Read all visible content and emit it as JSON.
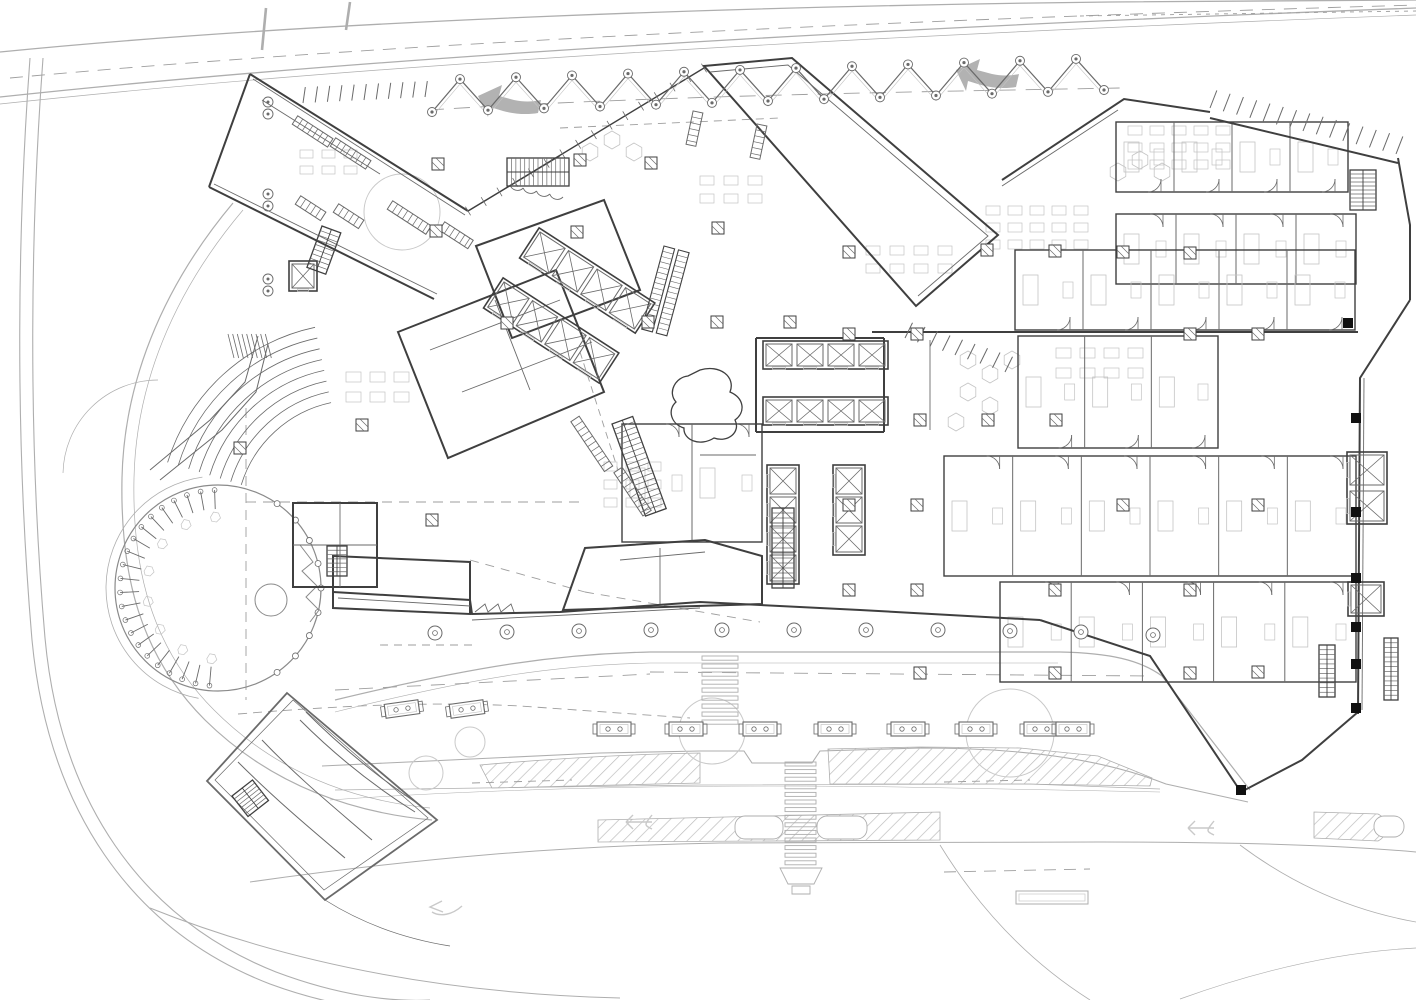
{
  "meta": {
    "drawing_type": "architectural-ground-floor-site-plan",
    "has_text_labels": false
  },
  "colors": {
    "bg": "#ffffff",
    "wall": "#3f3f3f",
    "partition": "#6a6a6a",
    "site": "#aeaeae",
    "siteLight": "#c9c9c9",
    "detail": "#c4c4c4",
    "dash": "#9e9e9e",
    "arrowFill": "#b2b2b2",
    "hatch": "#bdbdbd",
    "black": "#111111",
    "courtyard": "#8a8a8a"
  },
  "site": {
    "roads": [
      {
        "d": "M0,52 C320,20 760,6 1110,2 L1416,0",
        "w": 1.3
      },
      {
        "d": "M0,97 C380,56 880,28 1416,8",
        "w": 1.3
      },
      {
        "d": "M0,104 C380,63 880,35 1416,15",
        "w": 0.7
      },
      {
        "d": "M30,58 C18,220 14,430 32,640 C48,808 130,930 270,984 C330,1006 380,1012 420,1012",
        "w": 1.1
      },
      {
        "d": "M43,58 C31,220 27,430 45,638 C60,800 140,918 276,972 C340,996 392,1002 430,1000",
        "w": 1.1
      },
      {
        "d": "M233,203 C160,290 124,385 122,478 C120,575 140,655 205,720 C268,782 345,812 432,820",
        "w": 1.2
      },
      {
        "d": "M243,210 C172,294 136,386 134,478 C132,570 152,648 214,710 C274,770 348,800 430,808",
        "w": 0.7
      },
      {
        "d": "M63,473 A95,95 0 0 1 158,380",
        "w": 0.7
      },
      {
        "d": "M335,700 C480,665 560,654 650,652 L1060,652 C1110,653 1140,660 1162,676 L1250,790",
        "w": 1.2
      },
      {
        "d": "M335,712 C480,676 560,665 650,663 L1058,663",
        "w": 0.6
      },
      {
        "d": "M322,766 L600,753 L700,751 L744,751 L752,763 L812,763 L820,751 L920,748 C1020,748 1100,758 1166,784 L1248,802",
        "w": 1.1
      },
      {
        "d": "M335,790 L700,785 L1030,784 L1160,789",
        "w": 0.7
      },
      {
        "d": "M250,882 C420,858 560,846 720,843 L1100,842 C1250,842 1350,846 1416,852",
        "w": 1.0
      },
      {
        "d": "M150,908 C300,968 460,994 620,998",
        "w": 1.0
      },
      {
        "d": "M940,845 C980,910 1030,962 1090,1000",
        "w": 0.8
      },
      {
        "d": "M1240,845 C1300,890 1360,912 1416,922",
        "w": 0.8
      },
      {
        "d": "M1180,999 C1260,970 1340,952 1416,948",
        "w": 0.7
      },
      {
        "d": "M330,800 C500,788 700,784 900,787 L1160,792",
        "w": 0.5
      },
      {
        "d": "M266,8 L262,50",
        "w": 2.6
      },
      {
        "d": "M346,30 L350,2",
        "w": 2.6
      }
    ],
    "dashes": [
      {
        "d": "M10,78 C400,42 900,20 1416,5",
        "p": "13,9"
      },
      {
        "d": "M1080,16 L1416,11",
        "p": "4,5"
      },
      {
        "d": "M428,110 C650,96 900,92 1120,88",
        "p": "16,10"
      },
      {
        "d": "M560,128 L780,118",
        "p": "8,6"
      },
      {
        "d": "M238,714 C360,704 440,702 520,706 L690,718",
        "p": "9,6"
      },
      {
        "d": "M650,672 L1150,676",
        "p": "14,10"
      },
      {
        "d": "M335,690 L650,674",
        "p": "14,10"
      },
      {
        "d": "M472,783 L572,780",
        "p": "8,6"
      },
      {
        "d": "M944,782 L1030,780",
        "p": "8,6"
      },
      {
        "d": "M246,502 L585,502",
        "p": "10,7"
      },
      {
        "d": "M246,408 L246,700",
        "p": "10,7"
      },
      {
        "d": "M380,645 L475,645",
        "p": "8,6"
      },
      {
        "d": "M585,592 L760,622",
        "p": "9,7"
      },
      {
        "d": "M470,560 L585,592",
        "p": "9,7"
      },
      {
        "d": "M944,872 L1090,869",
        "p": "12,8"
      },
      {
        "d": "M580,352 L618,470",
        "p": "7,5"
      }
    ],
    "medians": [
      "M480,765 C560,758 640,754 700,753 L700,783 L492,788 Z",
      "M828,749 L920,747 L1020,748 L1098,756 L1152,778 L1150,786 L1020,784 L830,784 Z",
      "M598,842 L598,820 L940,812 L940,840 Z",
      "M1314,812 L1378,814 A15,15 0 0 1 1378,841 L1314,838 Z"
    ],
    "medianSlots": [
      [
        735,
        816,
        48,
        23
      ],
      [
        817,
        816,
        50,
        23
      ],
      [
        1374,
        816,
        30,
        21
      ]
    ],
    "trees": [
      [
        402,
        212,
        38
      ],
      [
        712,
        731,
        33
      ],
      [
        426,
        773,
        17
      ],
      [
        470,
        742,
        15
      ],
      [
        1010,
        733,
        44
      ]
    ],
    "arrows": [
      {
        "d": "M478,96 l24,-11 l-3,11 l15,4 c9,2 18,2 27,0 l-3,13 c-11,2 -24,1 -35,-2 l-13,-4 l-2,10 Z"
      },
      {
        "d": "M956,70 l24,-11 l-3,11 l15,4 c9,2 18,2 27,0 l-3,13 c-11,2 -24,1 -35,-2 l-13,-4 l-2,10 Z"
      }
    ],
    "arrowOutlines": [
      "M652,822 h-26 m0,0 l7,-7 m-7,7 l7,7 m19,-14 c-8,10 -8,10 0,14",
      "M1214,828 h-26 m0,0 l7,-7 m-7,7 l7,7 m19,-14 c-8,10 -8,10 0,14",
      "M462,906 c-10,9 -22,11 -30,6 m10,-11 l-12,6 l13,5"
    ],
    "crosswalks": [
      {
        "x": 702,
        "w": 36,
        "y0": 656,
        "n": 9,
        "dy": 8.0,
        "h": 4.2
      },
      {
        "x": 785,
        "w": 31,
        "y0": 762,
        "n": 14,
        "dy": 7.6,
        "h": 4.0
      }
    ],
    "crossExtras": [
      "M780,868 L822,868 L814,884 L788,884 Z",
      "M792,886 h18 v8 h-18 Z"
    ],
    "benches": [
      [
        402,
        709,
        -8
      ],
      [
        467,
        709,
        -8
      ],
      [
        614,
        729,
        0
      ],
      [
        686,
        729,
        0
      ],
      [
        760,
        729,
        0
      ],
      [
        835,
        729,
        0
      ],
      [
        908,
        729,
        0
      ],
      [
        976,
        729,
        0
      ],
      [
        1041,
        729,
        0
      ],
      [
        1073,
        729,
        0
      ]
    ],
    "busShelter": {
      "x": 1016,
      "y": 891,
      "w": 72,
      "h": 13
    },
    "plazaColumns": [
      [
        435,
        633
      ],
      [
        507,
        632
      ],
      [
        579,
        631
      ],
      [
        651,
        630
      ],
      [
        722,
        630
      ],
      [
        794,
        630
      ],
      [
        866,
        630
      ],
      [
        938,
        630
      ],
      [
        1010,
        631
      ],
      [
        1081,
        632
      ],
      [
        1153,
        635
      ]
    ]
  },
  "building": {
    "walls": [
      "M250,74 L468,211",
      "M209,187 L434,299",
      "M250,74 L209,187",
      "M704,66 L792,58 L998,235 L916,306 Z",
      "M1002,180 L1124,99 L1210,112",
      "M1210,118 L1398,163",
      "M1398,158 L1410,225 L1410,300",
      "M1410,300 L1360,378 L1358,714",
      "M1040,620 L1150,656 L1241,792 L1302,760 L1358,712",
      "M333,592 L470,600 L472,614 L560,612 L700,602 L860,610 L1040,620",
      "M333,556 L470,562 L470,614 L333,608 Z",
      "M293,503 h84 v84 h-84 Z",
      "M563,610 L585,548 L705,540 L762,556 L762,604 Z",
      "M398,332 L556,270 L604,392 L448,458 Z",
      "M476,246 L604,200 L640,290 L512,338 Z",
      "M756,338 L884,338 M756,432 L884,432 M756,338 L756,432 M884,338 L884,432",
      "M872,332 L1358,332"
    ],
    "innerWalls": [
      "M253,79 L465,215",
      "M214,184 L437,294",
      "M710,72 L788,65 L988,236 L918,296",
      "M1364,378 L1362,710",
      "M338,598 L470,606",
      "M472,620 L700,608",
      "M293,545 h84",
      "M340,503 v84",
      "M470,210 L560,156",
      "M430,350 L560,300",
      "M462,392 L592,342",
      "M495,300 L530,390",
      "M620,560 L705,552",
      "M660,548 L660,604",
      "M1002,186 L1118,110",
      "M262,100 L380,174",
      "M930,340 L930,430",
      "M700,455 L756,455"
    ],
    "glass": {
      "x1": 468,
      "y1": 211,
      "x2": 704,
      "y2": 68,
      "n": 15
    },
    "scallops": {
      "x1": 510,
      "y1": 185,
      "x2": 563,
      "y2": 197,
      "n": 4,
      "r": 8
    },
    "sawtooth": "M475,612 l10,-8 l3,8 l10,-8 l3,8 l10,-8 l3,8",
    "roomRows": [
      {
        "x": 1116,
        "y": 122,
        "w": 232,
        "h": 70,
        "n": 4,
        "doors": "bottom"
      },
      {
        "x": 1116,
        "y": 214,
        "w": 240,
        "h": 70,
        "n": 4,
        "doors": "top"
      },
      {
        "x": 1015,
        "y": 250,
        "w": 340,
        "h": 80,
        "n": 5,
        "doors": "bottom"
      },
      {
        "x": 1018,
        "y": 336,
        "w": 200,
        "h": 112,
        "n": 3,
        "doors": "bottom"
      },
      {
        "x": 944,
        "y": 456,
        "w": 412,
        "h": 120,
        "n": 6,
        "doors": "top"
      },
      {
        "x": 1000,
        "y": 582,
        "w": 356,
        "h": 100,
        "n": 5,
        "doors": "top"
      },
      {
        "x": 622,
        "y": 424,
        "w": 140,
        "h": 118,
        "n": 2,
        "doors": "top"
      }
    ],
    "elevBanks": [
      {
        "x": 540,
        "y": 232,
        "rot": 33,
        "n": 4,
        "cw": 30,
        "ch": 30,
        "gap": 4
      },
      {
        "x": 504,
        "y": 282,
        "rot": 33,
        "n": 4,
        "cw": 30,
        "ch": 30,
        "gap": 4
      },
      {
        "x": 766,
        "y": 344,
        "rot": 0,
        "n": 4,
        "cw": 26,
        "ch": 22,
        "gap": 5
      },
      {
        "x": 766,
        "y": 400,
        "rot": 0,
        "n": 4,
        "cw": 26,
        "ch": 22,
        "gap": 5
      },
      {
        "x": 796,
        "y": 468,
        "rot": 90,
        "n": 4,
        "cw": 26,
        "ch": 26,
        "gap": 3
      },
      {
        "x": 862,
        "y": 468,
        "rot": 90,
        "n": 3,
        "cw": 26,
        "ch": 26,
        "gap": 3
      },
      {
        "x": 1384,
        "y": 455,
        "rot": 90,
        "n": 2,
        "cw": 30,
        "ch": 34,
        "gap": 6
      },
      {
        "x": 1381,
        "y": 585,
        "rot": 90,
        "n": 1,
        "cw": 28,
        "ch": 30,
        "gap": 4
      },
      {
        "x": 292,
        "y": 264,
        "rot": 0,
        "n": 1,
        "cw": 22,
        "ch": 24,
        "gap": 4
      }
    ],
    "stairs": [
      {
        "x": 507,
        "y": 158,
        "w": 62,
        "h": 28,
        "run": "h",
        "n": 14,
        "rot": 0
      },
      {
        "x": 772,
        "y": 508,
        "w": 22,
        "h": 80,
        "run": "v",
        "n": 16,
        "rot": 0
      },
      {
        "x": 1350,
        "y": 170,
        "w": 26,
        "h": 40,
        "run": "v",
        "n": 10,
        "rot": 0
      },
      {
        "x": 1319,
        "y": 645,
        "w": 16,
        "h": 52,
        "run": "v",
        "n": 11,
        "rot": 0
      },
      {
        "x": 1384,
        "y": 638,
        "w": 14,
        "h": 62,
        "run": "v",
        "n": 13,
        "rot": 0
      },
      {
        "x": 327,
        "y": 546,
        "w": 20,
        "h": 30,
        "run": "v",
        "n": 7,
        "rot": 0
      },
      {
        "x": 232,
        "y": 796,
        "w": 26,
        "h": 26,
        "run": "v",
        "n": 7,
        "rot": -38
      },
      {
        "x": 612,
        "y": 424,
        "w": 22,
        "h": 98,
        "run": "v",
        "n": 18,
        "rot": -20
      },
      {
        "x": 322,
        "y": 226,
        "w": 20,
        "h": 44,
        "run": "v",
        "n": 9,
        "rot": 20
      }
    ],
    "escalators": [
      {
        "x": 664,
        "y": 246,
        "len": 86,
        "wd": 11,
        "gap": 4,
        "rot": 15,
        "n": 16
      }
    ],
    "hatchBars": [
      [
        295,
        120,
        42,
        33
      ],
      [
        333,
        142,
        42,
        33
      ],
      [
        298,
        200,
        30,
        33
      ],
      [
        336,
        208,
        30,
        33
      ],
      [
        390,
        205,
        46,
        33
      ],
      [
        442,
        226,
        34,
        33
      ],
      [
        575,
        419,
        60,
        56
      ],
      [
        618,
        470,
        52,
        56
      ],
      [
        698,
        112,
        34,
        102
      ],
      [
        762,
        125,
        34,
        102
      ]
    ],
    "finRows": [
      {
        "x1": 1210,
        "y1": 108,
        "x2": 1396,
        "y2": 154,
        "n": 14,
        "len": 16
      },
      {
        "x1": 905,
        "y1": 338,
        "x2": 1005,
        "y2": 372,
        "n": 8,
        "len": 14
      },
      {
        "x1": 303,
        "y1": 103,
        "x2": 425,
        "y2": 97,
        "n": 10,
        "len": 14
      }
    ],
    "canopy": {
      "x0": 432,
      "y0": 112,
      "half": 28,
      "amp": 32,
      "n": 24,
      "slope": -22
    },
    "columns": [
      [
        438,
        164
      ],
      [
        580,
        160
      ],
      [
        651,
        163
      ],
      [
        436,
        231
      ],
      [
        577,
        232
      ],
      [
        718,
        228
      ],
      [
        507,
        323
      ],
      [
        648,
        322
      ],
      [
        717,
        322
      ],
      [
        790,
        322
      ],
      [
        849,
        252
      ],
      [
        987,
        250
      ],
      [
        1055,
        251
      ],
      [
        1123,
        252
      ],
      [
        1190,
        253
      ],
      [
        849,
        334
      ],
      [
        917,
        334
      ],
      [
        1190,
        334
      ],
      [
        1258,
        334
      ],
      [
        920,
        420
      ],
      [
        988,
        420
      ],
      [
        1056,
        420
      ],
      [
        849,
        505
      ],
      [
        917,
        505
      ],
      [
        1123,
        505
      ],
      [
        1258,
        505
      ],
      [
        849,
        590
      ],
      [
        917,
        590
      ],
      [
        1055,
        590
      ],
      [
        1190,
        590
      ],
      [
        920,
        673
      ],
      [
        1055,
        673
      ],
      [
        1190,
        673
      ],
      [
        1258,
        672
      ],
      [
        362,
        425
      ],
      [
        432,
        520
      ],
      [
        240,
        448
      ]
    ],
    "pairCircles": [
      [
        268,
        108
      ],
      [
        268,
        200
      ],
      [
        268,
        285
      ]
    ],
    "blackColumns": [
      [
        1356,
        418
      ],
      [
        1356,
        512
      ],
      [
        1356,
        578
      ],
      [
        1356,
        627
      ],
      [
        1356,
        664
      ],
      [
        1356,
        708
      ],
      [
        1348,
        323
      ],
      [
        1241,
        790
      ]
    ],
    "desk": "M700,370 C720,364 736,377 730,392 C744,398 746,412 735,420 C741,432 728,443 714,438 C700,447 683,440 684,428 C671,424 667,410 676,402 C667,392 676,377 688,376 Z",
    "hexes": [
      [
        968,
        360
      ],
      [
        990,
        374
      ],
      [
        1012,
        360
      ],
      [
        968,
        392
      ],
      [
        990,
        406
      ],
      [
        956,
        422
      ],
      [
        612,
        140
      ],
      [
        634,
        152
      ],
      [
        590,
        152
      ],
      [
        1140,
        160
      ],
      [
        1162,
        172
      ],
      [
        1118,
        172
      ]
    ],
    "furniture": [
      {
        "x": 986,
        "y": 206,
        "cols": 5,
        "rows": 3,
        "dx": 22,
        "dy": 17,
        "w": 14,
        "h": 9
      },
      {
        "x": 1128,
        "y": 126,
        "cols": 5,
        "rows": 3,
        "dx": 22,
        "dy": 17,
        "w": 14,
        "h": 9
      },
      {
        "x": 604,
        "y": 462,
        "cols": 3,
        "rows": 3,
        "dx": 22,
        "dy": 18,
        "w": 13,
        "h": 9
      },
      {
        "x": 346,
        "y": 372,
        "cols": 3,
        "rows": 2,
        "dx": 24,
        "dy": 20,
        "w": 15,
        "h": 10
      },
      {
        "x": 1056,
        "y": 348,
        "cols": 4,
        "rows": 2,
        "dx": 24,
        "dy": 20,
        "w": 15,
        "h": 10
      },
      {
        "x": 700,
        "y": 176,
        "cols": 3,
        "rows": 2,
        "dx": 24,
        "dy": 18,
        "w": 14,
        "h": 9
      },
      {
        "x": 866,
        "y": 246,
        "cols": 4,
        "rows": 2,
        "dx": 24,
        "dy": 18,
        "w": 14,
        "h": 9
      },
      {
        "x": 300,
        "y": 150,
        "cols": 3,
        "rows": 2,
        "dx": 22,
        "dy": 16,
        "w": 13,
        "h": 8
      }
    ]
  },
  "courtyard": {
    "cx": 218,
    "cy": 588,
    "r": 103,
    "r2": 112,
    "teethA0": 95,
    "teethA1": 268,
    "teethN": 21,
    "rimBumpsA0": -55,
    "rimBumpsA1": 55,
    "rimBumpsN": 8,
    "pond": [
      271,
      600,
      16
    ],
    "squiggle": "M300,545 l13,17 l-11,9 l15,15 l-11,11 l13,13 l-9,12"
  },
  "amphitheater": {
    "cx": 356,
    "cy": 520,
    "r0": 120,
    "dr": 11,
    "n": 8,
    "a0": 197,
    "a1": 258,
    "fan": {
      "x": 228,
      "y": 334,
      "w": 42,
      "h": 24,
      "n": 9
    },
    "edges": [
      "M150,470 L210,420 L245,382 L258,336",
      "M160,480 L222,430 L256,392 L268,344"
    ]
  },
  "ramp": {
    "paths": [
      {
        "d": "M287,693 L437,820 L325,900 L207,781 Z",
        "w": 1.8
      },
      {
        "d": "M293,700 L428,818 L324,890 L215,780 Z",
        "w": 0.7
      },
      {
        "d": "M300,720 C340,760 380,790 415,812",
        "w": 1.0
      },
      {
        "d": "M306,712 C346,752 388,784 421,806",
        "w": 1.0
      },
      {
        "d": "M262,740 C300,780 340,812 372,840",
        "w": 1.0
      },
      {
        "d": "M238,762 C276,800 312,830 345,858",
        "w": 1.0
      },
      {
        "d": "M325,900 C360,922 400,938 450,946",
        "w": 0.7
      }
    ]
  }
}
